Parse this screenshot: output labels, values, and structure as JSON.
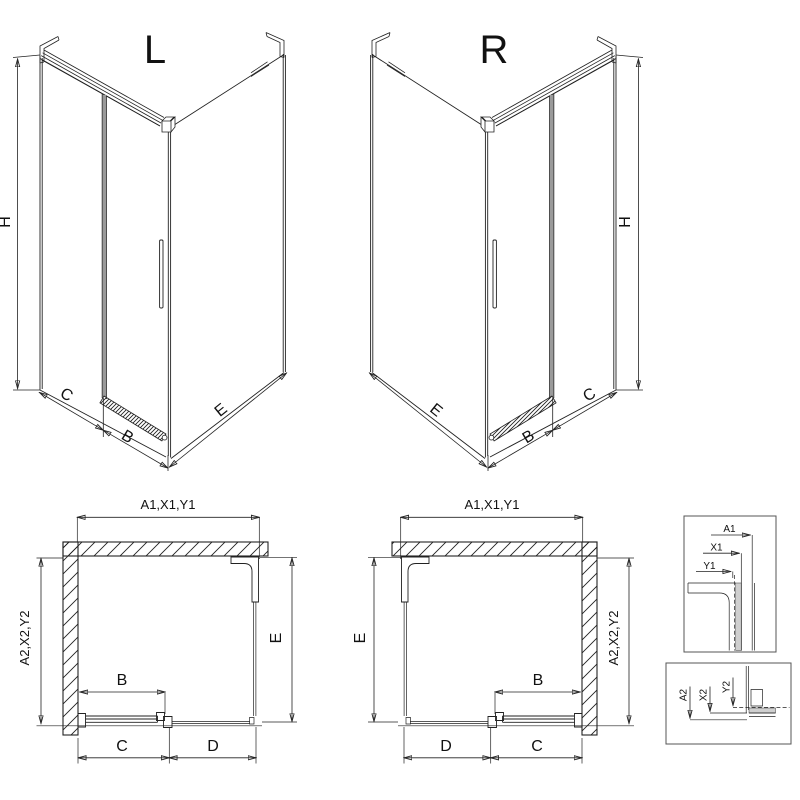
{
  "colors": {
    "line": "#222222",
    "door_profile_gray": "#9a9a9a",
    "background": "#ffffff",
    "detail_strip": "#cfcfcf"
  },
  "iso_left": {
    "title": "L",
    "dim_height": "H",
    "dim_fixed": "C",
    "dim_door": "B",
    "dim_side": "E"
  },
  "iso_right": {
    "title": "R",
    "dim_height": "H",
    "dim_fixed": "C",
    "dim_door": "B",
    "dim_side": "E"
  },
  "plan_left": {
    "dim_top": "A1,X1,Y1",
    "dim_left": "A2,X2,Y2",
    "dim_door": "B",
    "dim_bottom_left": "C",
    "dim_bottom_right": "D",
    "dim_side": "E"
  },
  "plan_right": {
    "dim_top": "A1,X1,Y1",
    "dim_right": "A2,X2,Y2",
    "dim_door": "B",
    "dim_bottom_left": "D",
    "dim_bottom_right": "C",
    "dim_side": "E"
  },
  "detail_top": {
    "dim_outer": "A1",
    "dim_mid": "X1",
    "dim_inner": "Y1"
  },
  "detail_bottom": {
    "dim_outer": "A2",
    "dim_mid": "X2",
    "dim_inner": "Y2"
  }
}
